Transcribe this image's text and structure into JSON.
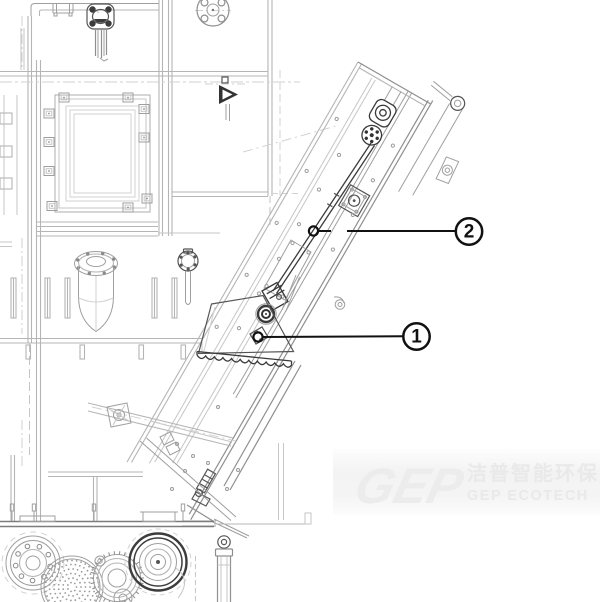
{
  "page": {
    "background": "#ffffff",
    "type": "technical-parts-diagram"
  },
  "callouts": [
    {
      "number": "1",
      "balloon": {
        "cx": 416.5,
        "cy": 336.5,
        "r": 13.2
      },
      "target": {
        "cx": 258,
        "cy": 337
      }
    },
    {
      "number": "2",
      "balloon": {
        "cx": 469,
        "cy": 231.5,
        "r": 13.2
      },
      "target": {
        "cx": 313.5,
        "cy": 231
      }
    }
  ],
  "watermark": {
    "logo_text": "GEP",
    "text_cn": "洁普智能环保",
    "text_en": "GEP ECOTECH"
  },
  "colors": {
    "line_dark": "#3a3a3a",
    "line_medium": "#8f8f8f",
    "line_light": "#b5b5b5",
    "callout_black": "#111111",
    "watermark_gray": "#ececec"
  }
}
